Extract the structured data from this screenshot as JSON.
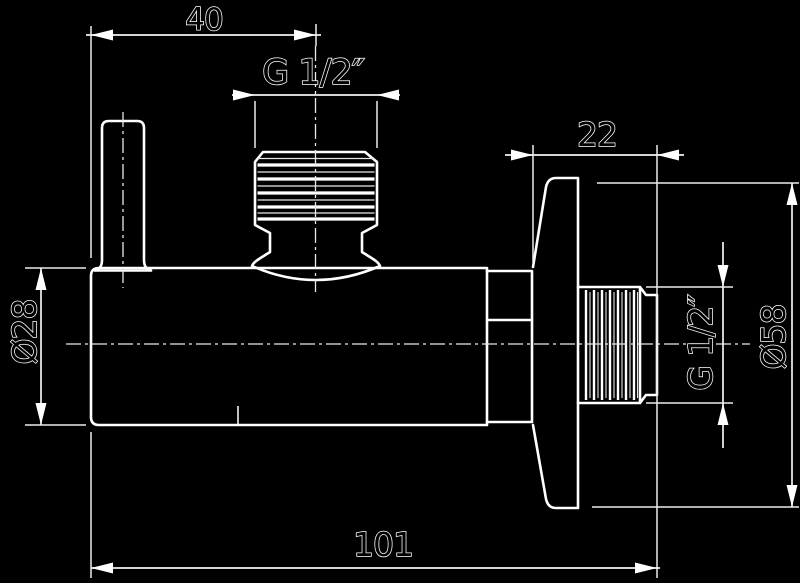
{
  "drawing": {
    "title": "angle-valve-technical-drawing",
    "background_color": "#000000",
    "line_color": "#ffffff",
    "style": "outlined white strokes on black, DIN-style dimensioning",
    "dimensions": {
      "handle_offset": "40",
      "inlet_thread": "G 1/2″",
      "outlet_projection": "22",
      "body_diameter": "Ø28",
      "rosette_diameter": "Ø58",
      "outlet_thread": "G 1/2″",
      "total_length": "101"
    }
  }
}
